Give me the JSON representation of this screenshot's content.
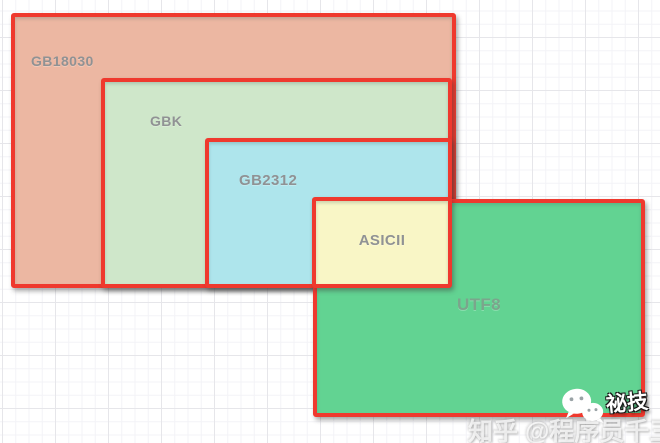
{
  "diagram": {
    "description": "Nested character-encoding compatibility diagram",
    "regions": {
      "gb18030": {
        "label": "GB18030",
        "fill": "#ecb7a2"
      },
      "gbk": {
        "label": "GBK",
        "fill": "#cfe7ca"
      },
      "gb2312": {
        "label": "GB2312",
        "fill": "#aee5ec"
      },
      "asicii": {
        "label": "ASICII",
        "fill": "#f9f6c6"
      },
      "utf8": {
        "label": "UTF8",
        "fill": "#62d392"
      }
    },
    "border_color": "#ef392e",
    "label_color": "#909294"
  },
  "watermark": {
    "zhihu_text": "知乎 @程序员千三",
    "wechat_badge_text": "祕技",
    "icons": {
      "wechat": "wechat-icon"
    }
  }
}
